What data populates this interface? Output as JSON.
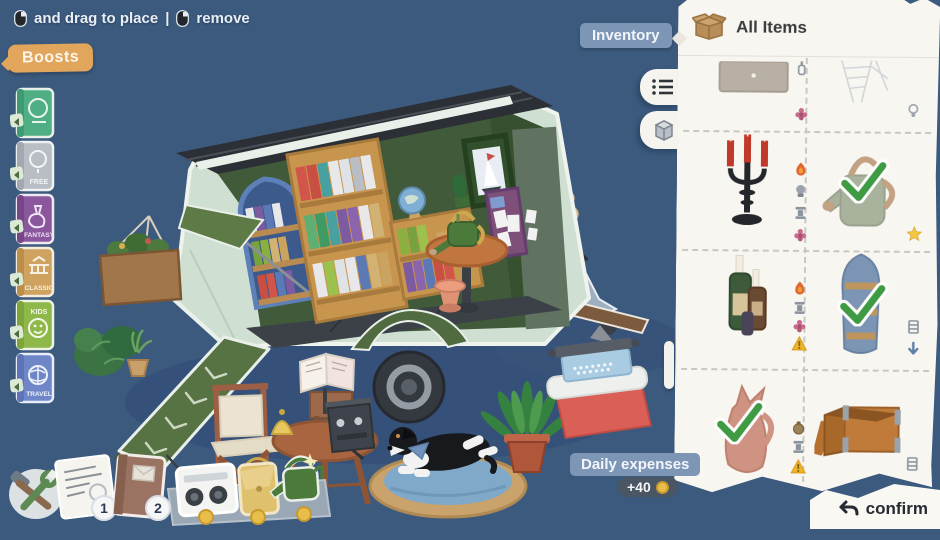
{
  "colors": {
    "background": "#3b5a7e",
    "panel": "#f8f6f1",
    "boosts_accent": "#e2a55c",
    "label_blue": "#7e96b6",
    "expense_pill": "#4a5663",
    "coin_gold": "#e9bd4a",
    "check_green": "#3f9b43",
    "trailer_mint": "#cfe0d2",
    "interior_green": "#405a3a"
  },
  "hint": {
    "drag_label": "and drag to place",
    "separator": "|",
    "remove_label": "remove"
  },
  "boosts": {
    "label": "Boosts",
    "books": [
      {
        "genre": "",
        "cover_color": "#4fae84"
      },
      {
        "genre": "FREE",
        "cover_color": "#b9bdc4"
      },
      {
        "genre": "FANTASY",
        "cover_color": "#8a569c"
      },
      {
        "genre": "CLASSIC",
        "cover_color": "#cfa35f"
      },
      {
        "genre": "KIDS",
        "cover_color": "#8fb84a"
      },
      {
        "genre": "TRAVEL",
        "cover_color": "#6f86c9"
      }
    ]
  },
  "inventory": {
    "label": "Inventory",
    "title": "All Items",
    "view_tabs": [
      "list-view",
      "grid-view"
    ],
    "items": [
      {
        "name": "dresser",
        "status_icons": [
          "bottle",
          "flower"
        ],
        "checked": false
      },
      {
        "name": "ladder",
        "status_icons": [
          "lightbulb"
        ],
        "checked": false,
        "ghost": true
      },
      {
        "name": "candelabra",
        "status_icons": [
          "flame",
          "lamp",
          "pedestal",
          "flower"
        ],
        "checked": false
      },
      {
        "name": "watering-can",
        "status_icons": [],
        "checked": true,
        "starred": true
      },
      {
        "name": "bottle-candles",
        "status_icons": [
          "flame",
          "pedestal",
          "flower",
          "warning"
        ],
        "checked": false
      },
      {
        "name": "boat-shelf",
        "status_icons": [
          "shelf",
          "down-arrow"
        ],
        "checked": true
      },
      {
        "name": "pitcher",
        "status_icons": [
          "bag",
          "pedestal",
          "warning"
        ],
        "checked": true
      },
      {
        "name": "wooden-crate",
        "status_icons": [
          "shelf"
        ],
        "checked": false
      }
    ]
  },
  "expenses": {
    "label": "Daily expenses",
    "amount": "+40"
  },
  "confirm_label": "confirm",
  "dock": {
    "badge_1": "1",
    "badge_2": "2"
  },
  "scene": {
    "props": [
      "trailer",
      "roof-panels",
      "bookshelf-tall",
      "bookshelf-low",
      "arch-bookshelf",
      "awning",
      "hanging-basket",
      "globe",
      "cactus",
      "picture-frame",
      "magazine-rack",
      "inside-table",
      "watering-can-table",
      "stool",
      "wheel",
      "fender",
      "ramp",
      "tow-bar",
      "scooter",
      "garlic-braid",
      "bush",
      "potted-grass",
      "fern",
      "director-chair",
      "round-table",
      "bell",
      "espresso-machine",
      "book-stand",
      "side-table",
      "dog",
      "dog-bed",
      "typewriter",
      "cooler",
      "dock-strip",
      "radio",
      "tote-bag",
      "dock-watering-can",
      "tools-sticker",
      "note-sticker",
      "journal-sticker"
    ]
  }
}
